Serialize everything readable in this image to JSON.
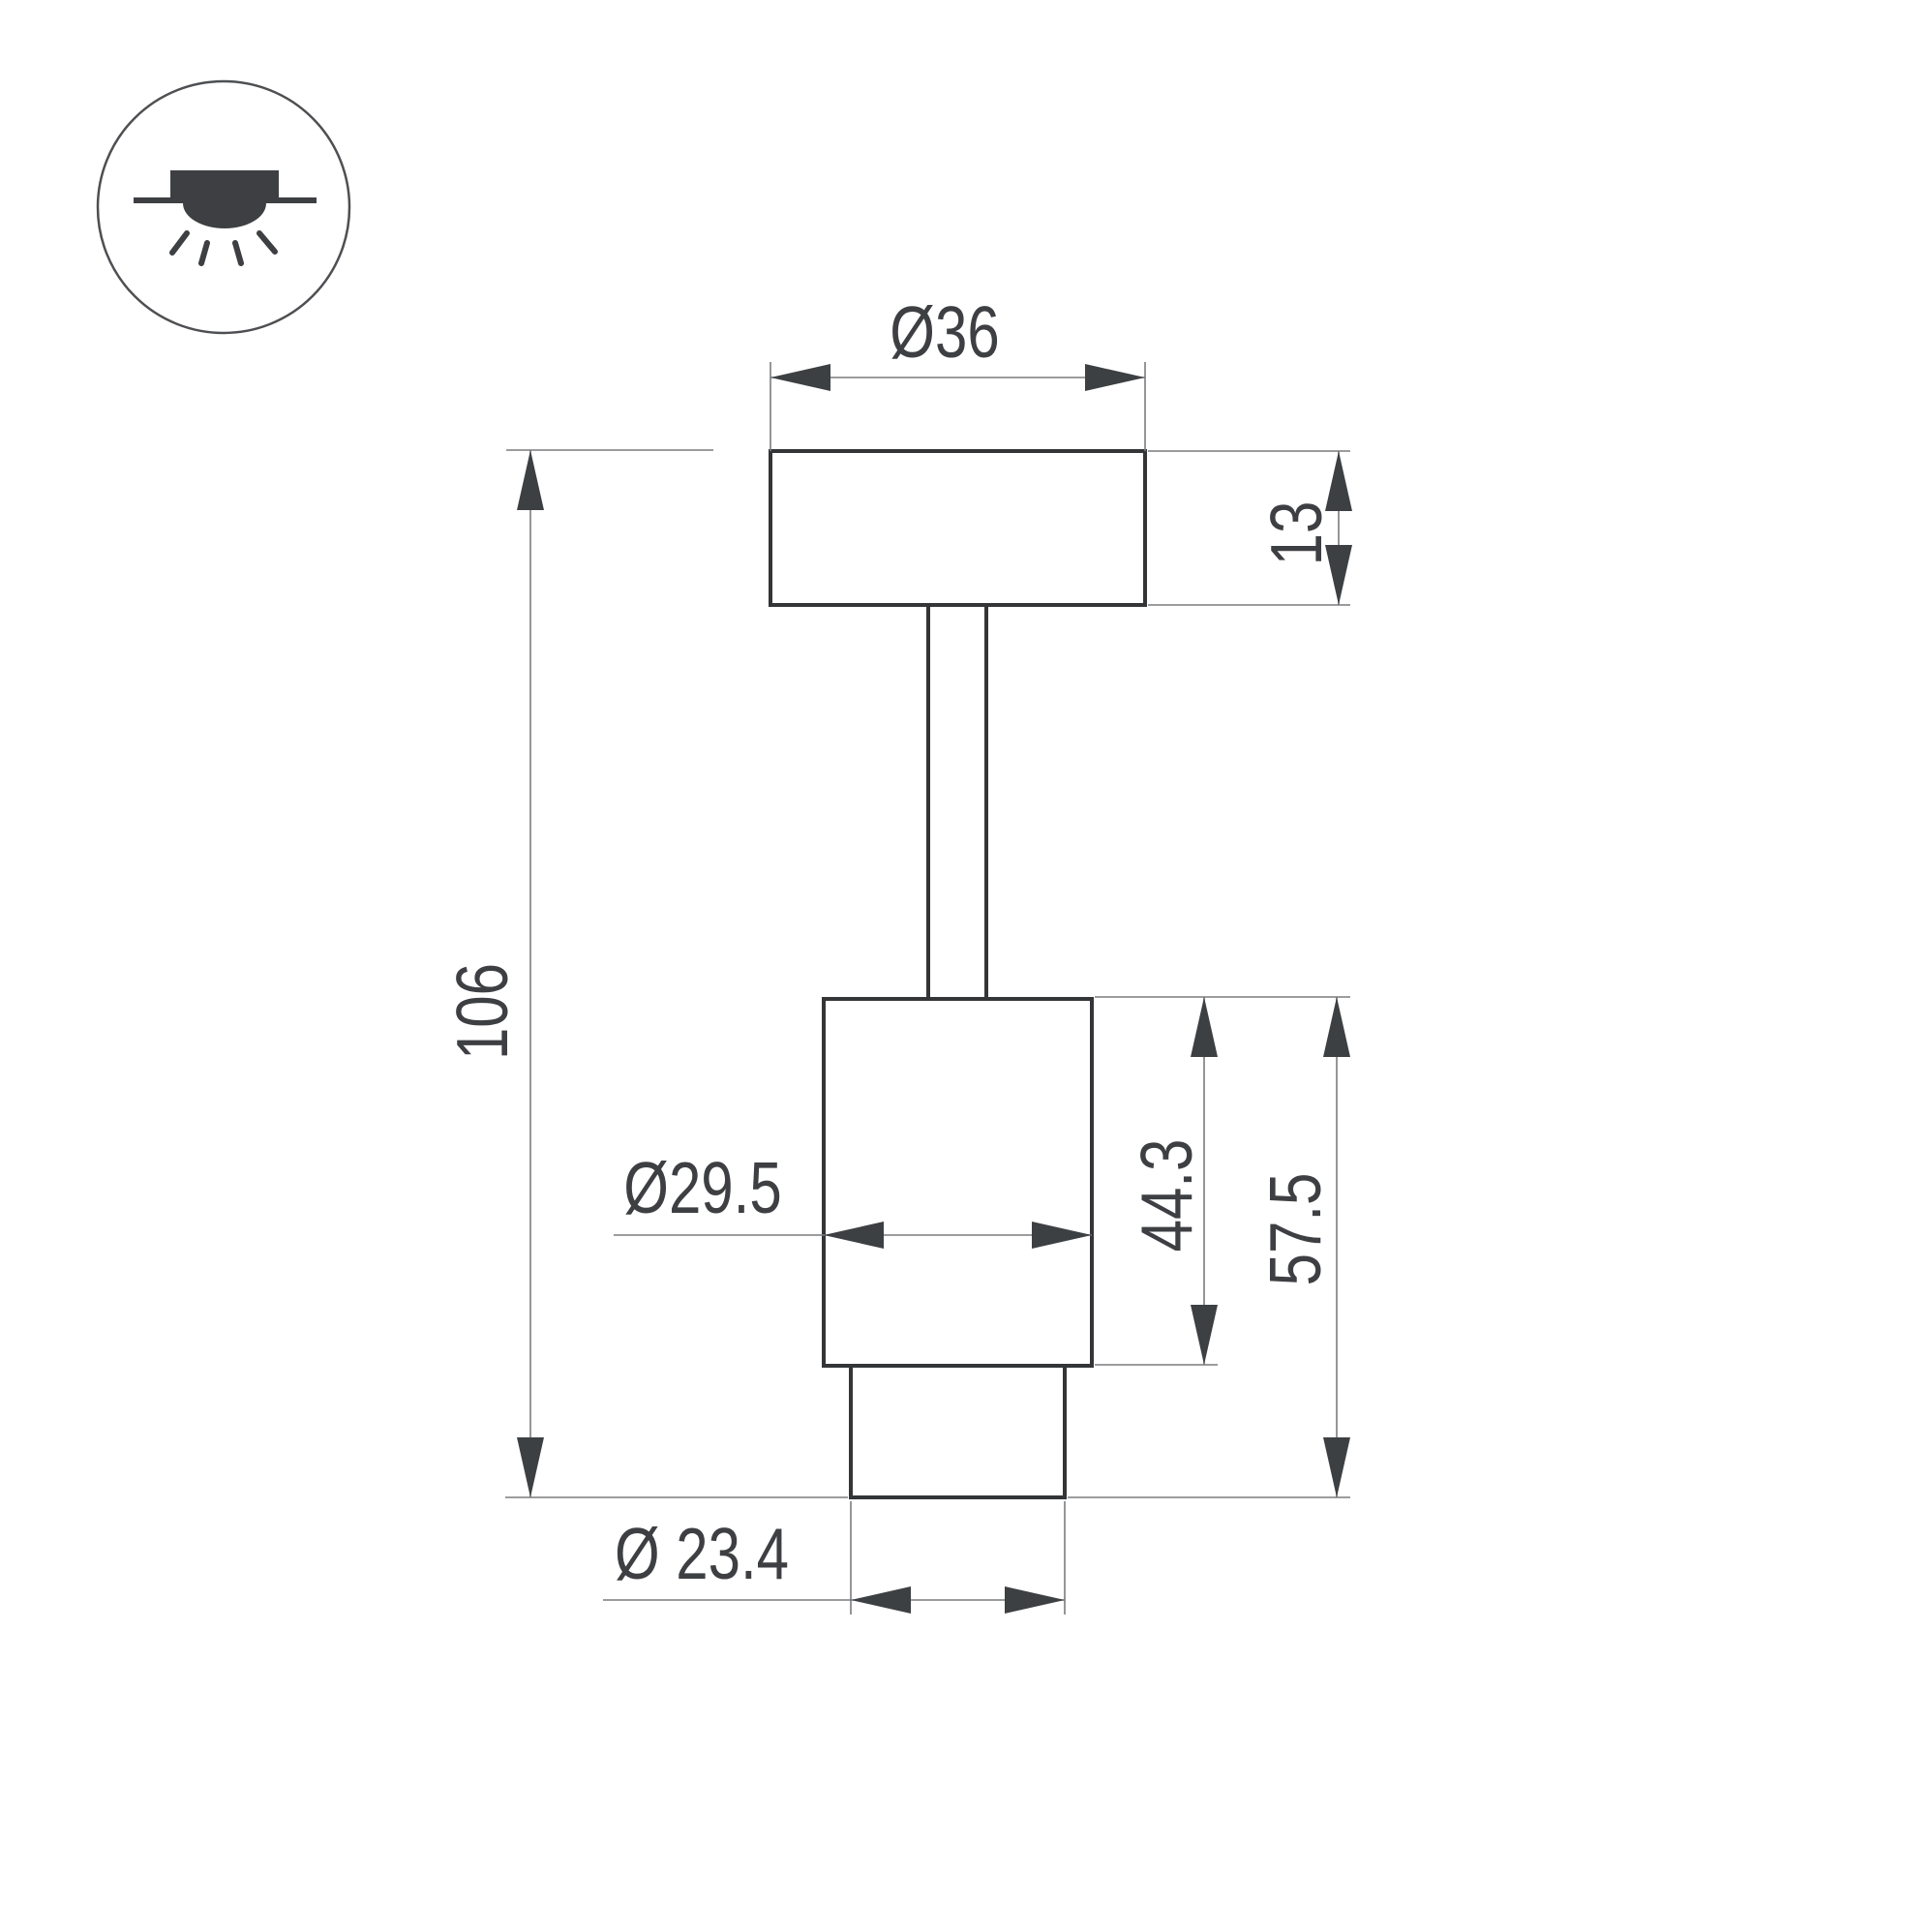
{
  "page": {
    "background": "#ffffff"
  },
  "icon": {
    "name": "surface-mounted-luminaire-icon"
  },
  "dimensions": {
    "canopy_diameter": "Ø36",
    "canopy_height": "13",
    "overall_height": "106",
    "body_diameter": "Ø29.5",
    "body_height": "44.3",
    "lower_section_height": "57.5",
    "nose_diameter": "Ø 23.4"
  },
  "colors": {
    "outline": "#333537",
    "dimension_line": "#7b7c7e",
    "arrow": "#3d4043",
    "text": "#3d3f42"
  }
}
